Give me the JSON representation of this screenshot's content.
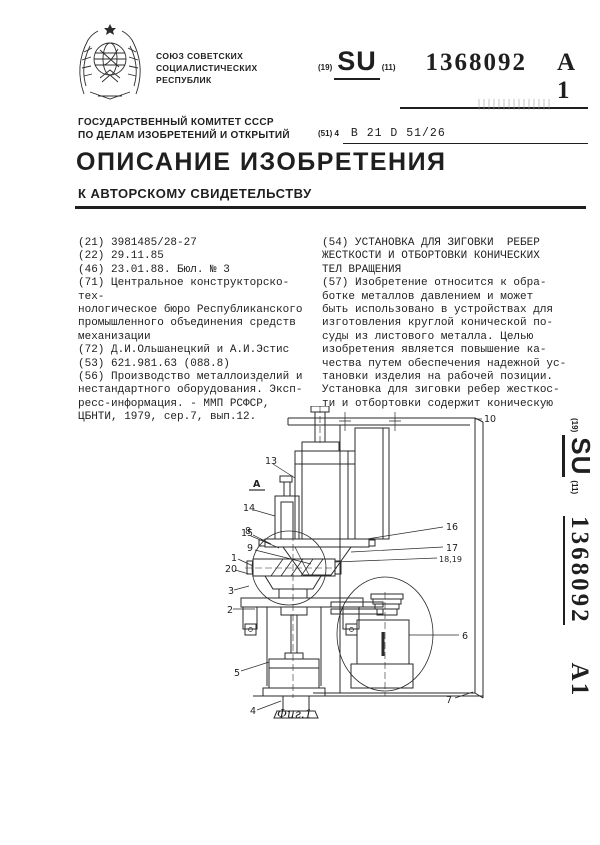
{
  "header": {
    "country_lines": "СОЮЗ СОВЕТСКИХ\nСОЦИАЛИСТИЧЕСКИХ\nРЕСПУБЛИК",
    "committee_lines": "ГОСУДАРСТВЕННЫЙ КОМИТЕТ СССР\nПО ДЕЛАМ ИЗОБРЕТЕНИЙ И ОТКРЫТИЙ",
    "code19_label": "(19)",
    "country_code": "SU",
    "code11_label": "(11)",
    "publication_number": "1368092",
    "kind_code": "A 1",
    "code51_label": "(51) 4",
    "ipc_code": "B 21 D 51/26"
  },
  "title_block": {
    "title": "ОПИСАНИЕ ИЗОБРЕТЕНИЯ",
    "subtitle": "К АВТОРСКОМУ СВИДЕТЕЛЬСТВУ"
  },
  "biblio": {
    "f21": "(21) 3981485/28-27",
    "f22": "(22) 29.11.85",
    "f46": "(46) 23.01.88. Бюл. № 3",
    "f71": "(71) Центральное конструкторско-тех-\nнологическое бюро Республиканского\nпромышленного объединения средств\nмеханизации",
    "f72": "(72) Д.И.Ольшанецкий и А.И.Эстис",
    "f53": "(53) 621.981.63 (088.8)",
    "f56": "(56) Производство металлоизделий и\nнестандартного оборудования. Эксп-\nресс-информация. - ММП РСФСР,\nЦБНТИ, 1979, сер.7, вып.12."
  },
  "abstract": {
    "f54": "(54) УСТАНОВКА ДЛЯ ЗИГОВКИ  РЕБЕР\nЖЕСТКОСТИ И ОТБОРТОВКИ КОНИЧЕСКИХ\nТЕЛ ВРАЩЕНИЯ",
    "f57": "(57) Изобретение относится к обра-\nботке металлов давлением и может\nбыть использовано в устройствах для\nизготовления круглой конической по-\nсуды из листового металла. Целью\nизобретения является повышение ка-\nчества путем обеспечения надежной ус-\nтановки изделия на рабочей позиции.\nУстановка для зиговки ребер жесткос-\nти и отбортовки содержит коническую"
  },
  "figure": {
    "caption": "Фиг.1",
    "section_label": "А",
    "callouts": {
      "c13": "13",
      "c14": "14",
      "c15": "15",
      "c8": "8",
      "c9": "9",
      "c1": "1",
      "c20": "20",
      "c3": "3",
      "c2": "2",
      "c5": "5",
      "c4": "4",
      "c10": "10",
      "c16": "16",
      "c17": "17",
      "c1819": "18,19",
      "c6": "6",
      "c7": "7"
    }
  },
  "sidebar": {
    "code19_label": "(19)",
    "country_code": "SU",
    "code11_label": "(11)",
    "publication_number": "1368092",
    "kind_code": "A1"
  }
}
